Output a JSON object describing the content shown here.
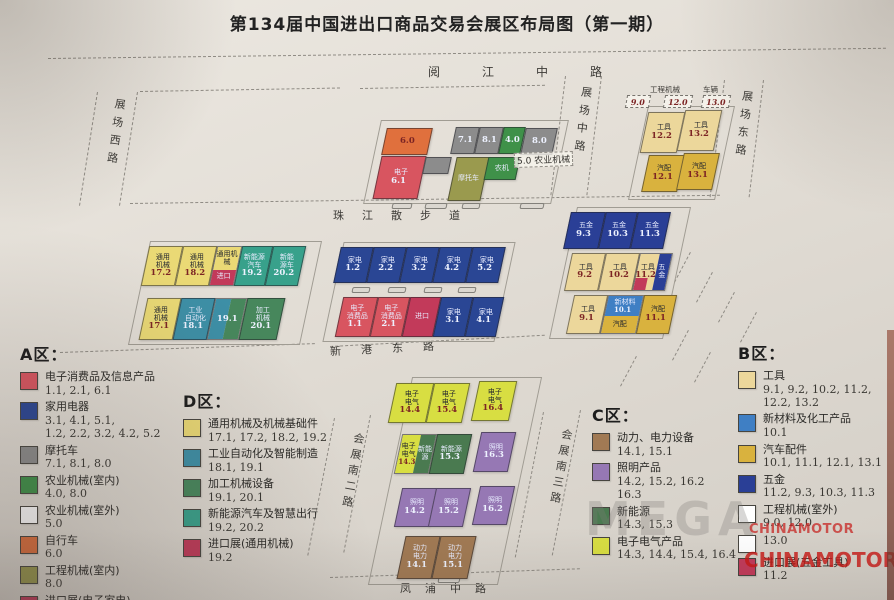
{
  "title": "第134届中国进出口商品交易会展区布局图（第一期）",
  "watermark": {
    "mega": "MEGA",
    "brand_small": "CHINAMOTOR",
    "brand_large": "CHINAMOTOR"
  },
  "roads": {
    "north": "阅江中路",
    "west": "展场西路",
    "center": "展场中路",
    "east": "展场东路",
    "promenade": "珠江散步道",
    "xingang": "新港东路",
    "south_w": "会展南二路",
    "south_e": "会展南三路",
    "fengpu": "凤浦中路"
  },
  "outdoor": {
    "eng_label": "工程机械",
    "eng_hall_1": "9.0",
    "eng_hall_2": "12.0",
    "veh_label": "车辆",
    "veh_hall": "13.0",
    "agri_note": "5.0 农业机械"
  },
  "colors": {
    "electronics": "#d85560",
    "appliance": "#2a4694",
    "motorcycle": "#8c8c8c",
    "agri_in": "#3f9149",
    "agri_out": "#ffffff",
    "bicycle": "#e0703d",
    "eng_in": "#9a9a4e",
    "import": "#c23a5a",
    "general_mach": "#ead975",
    "industrial_auto": "#3d8fa6",
    "processing": "#47875c",
    "nev": "#38a18b",
    "tool": "#ecd79b",
    "material": "#3f7fc4",
    "autoparts": "#d9b23e",
    "hardware": "#2a3f96",
    "eng_out": "#ffffff",
    "power": "#a17a54",
    "lighting": "#9678b4",
    "new_energy": "#4a7a50",
    "electric": "#d8de42"
  },
  "clusters": {
    "north_a": {
      "row1": [
        {
          "name": "",
          "num": "6.0"
        },
        {
          "name": "",
          "num": "7.1"
        },
        {
          "name": "",
          "num": "8.1"
        },
        {
          "name": "",
          "num": "4.0"
        },
        {
          "name": "",
          "num": "8.0"
        }
      ],
      "row2": [
        {
          "name": "电子",
          "num": "6.1"
        },
        {
          "name": "摩托车",
          "num": ""
        },
        {
          "name": "农机",
          "num": ""
        }
      ]
    },
    "north_b": {
      "row1": [
        {
          "name": "工具",
          "num": "12.2"
        },
        {
          "name": "工具",
          "num": "13.2"
        }
      ],
      "row2": [
        {
          "name": "汽配",
          "num": "12.1"
        },
        {
          "name": "汽配",
          "num": "13.1"
        }
      ]
    },
    "mid_d": {
      "row1": [
        {
          "name": "通用\n机械",
          "num": "17.2"
        },
        {
          "name": "通用\n机械",
          "num": "18.2"
        },
        {
          "top": "通用机械",
          "bottom": "进口"
        },
        {
          "name": "新能源\n汽车",
          "num": "19.2"
        },
        {
          "name": "新能\n源车",
          "num": "20.2"
        }
      ],
      "row2": [
        {
          "name": "通用\n机械",
          "num": "17.1"
        },
        {
          "name": "工业\n自动化",
          "num": "18.1"
        },
        {
          "num": "19.1"
        },
        {
          "name": "加工\n机械",
          "num": "20.1"
        }
      ]
    },
    "mid_a": {
      "row1": [
        {
          "name": "家电",
          "num": "1.2"
        },
        {
          "name": "家电",
          "num": "2.2"
        },
        {
          "name": "家电",
          "num": "3.2"
        },
        {
          "name": "家电",
          "num": "4.2"
        },
        {
          "name": "家电",
          "num": "5.2"
        }
      ],
      "row2": [
        {
          "name": "电子\n消费品",
          "num": "1.1"
        },
        {
          "name": "电子\n消费品",
          "num": "2.1"
        },
        {
          "name": "进口",
          "num": ""
        },
        {
          "name": "家电",
          "num": "3.1"
        },
        {
          "name": "家电",
          "num": "4.1"
        }
      ]
    },
    "mid_b": {
      "row1": [
        {
          "name": "五金",
          "num": "9.3"
        },
        {
          "name": "五金",
          "num": "10.3"
        },
        {
          "name": "五金",
          "num": "11.3"
        }
      ],
      "row2": [
        {
          "name": "工具",
          "num": "9.2"
        },
        {
          "name": "工具",
          "num": "10.2"
        },
        {
          "left_name": "工具",
          "left_num": "11.2",
          "right": "五金"
        }
      ],
      "row3": [
        {
          "name": "工具",
          "num": "9.1"
        },
        {
          "top_name": "新材料",
          "top_num": "10.1",
          "bottom": "汽配"
        },
        {
          "name": "汽配",
          "num": "11.1"
        }
      ]
    },
    "south_c": {
      "row1": [
        {
          "name": "电子\n电气",
          "num": "14.4"
        },
        {
          "name": "电子\n电气",
          "num": "15.4"
        },
        {
          "name": "电子\n电气",
          "num": "16.4"
        }
      ],
      "row2": [
        {
          "left_name": "电子\n电气",
          "left_num": "14.3",
          "right": "新能\n源"
        },
        {
          "name": "新能源",
          "num": "15.3"
        },
        {
          "name": "照明",
          "num": "16.3"
        }
      ],
      "row3": [
        {
          "name": "照明",
          "num": "14.2"
        },
        {
          "name": "照明",
          "num": "15.2"
        },
        {
          "name": "照明",
          "num": "16.2"
        }
      ],
      "row4": [
        {
          "name": "动力\n电力",
          "num": "14.1"
        },
        {
          "name": "动力\n电力",
          "num": "15.1"
        }
      ]
    }
  },
  "legend_a": {
    "title": "A区：",
    "items": [
      {
        "label": "电子消费品及信息产品",
        "halls": "1.1, 2.1, 6.1"
      },
      {
        "label": "家用电器",
        "halls": "3.1, 4.1, 5.1,\n1.2, 2.2, 3.2, 4.2, 5.2"
      },
      {
        "label": "摩托车",
        "halls": "7.1, 8.1, 8.0"
      },
      {
        "label": "农业机械(室内)",
        "halls": "4.0, 8.0"
      },
      {
        "label": "农业机械(室外)",
        "halls": "5.0"
      },
      {
        "label": "自行车",
        "halls": "6.0"
      },
      {
        "label": "工程机械(室内)",
        "halls": "8.0"
      },
      {
        "label": "进口展(电子家电)",
        "halls": ""
      }
    ]
  },
  "legend_d": {
    "title": "D区：",
    "items": [
      {
        "label": "通用机械及机械基础件",
        "halls": "17.1, 17.2, 18.2, 19.2"
      },
      {
        "label": "工业自动化及智能制造",
        "halls": "18.1, 19.1"
      },
      {
        "label": "加工机械设备",
        "halls": "19.1, 20.1"
      },
      {
        "label": "新能源汽车及智慧出行",
        "halls": "19.2, 20.2"
      },
      {
        "label": "进口展(通用机械)",
        "halls": "19.2"
      }
    ]
  },
  "legend_c": {
    "title": "C区：",
    "items": [
      {
        "label": "动力、电力设备",
        "halls": "14.1, 15.1"
      },
      {
        "label": "照明产品",
        "halls": "14.2, 15.2, 16.2\n16.3"
      },
      {
        "label": "新能源",
        "halls": "14.3, 15.3"
      },
      {
        "label": "电子电气产品",
        "halls": "14.3, 14.4, 15.4, 16.4"
      }
    ]
  },
  "legend_b": {
    "title": "B区：",
    "items": [
      {
        "label": "工具",
        "halls": "9.1, 9.2, 10.2, 11.2,\n12.2, 13.2"
      },
      {
        "label": "新材料及化工产品",
        "halls": "10.1"
      },
      {
        "label": "汽车配件",
        "halls": "10.1, 11.1, 12.1, 13.1"
      },
      {
        "label": "五金",
        "halls": "11.2, 9.3, 10.3, 11.3"
      },
      {
        "label": "工程机械(室外)",
        "halls": "9.0, 12.0"
      },
      {
        "label": "",
        "halls": "13.0"
      },
      {
        "label": "进口展(五金工具)",
        "halls": "11.2"
      }
    ]
  }
}
